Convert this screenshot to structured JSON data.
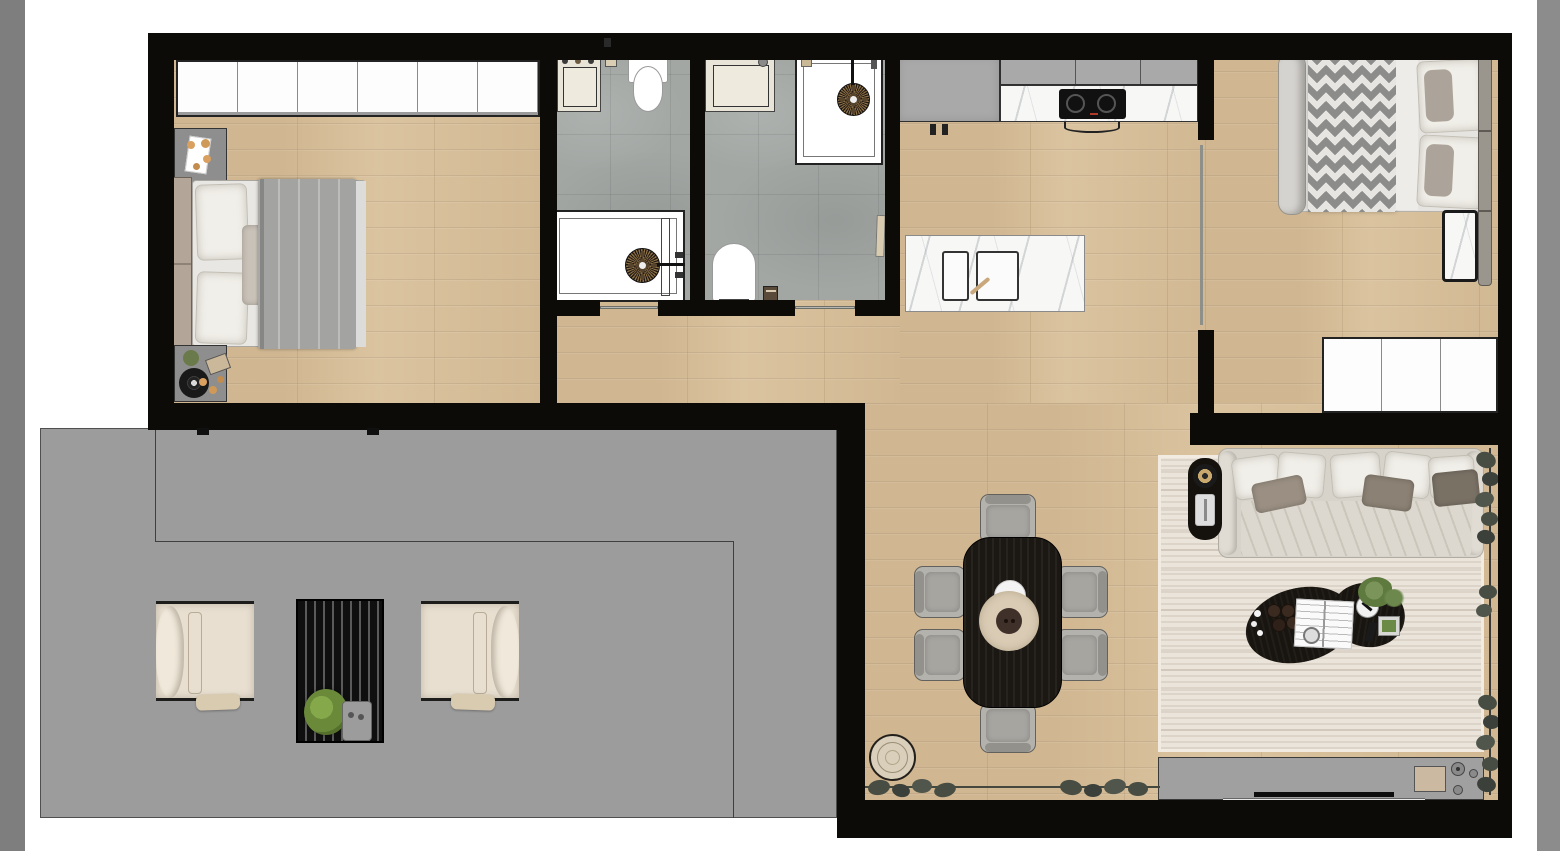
{
  "scene": {
    "kind": "apartment-floor-plan-top-view",
    "style": "rendered interior plan, no visible text labels",
    "canvas": {
      "width": 1560,
      "height": 851,
      "background": "#ffffff"
    }
  },
  "palette": {
    "wall": "#0d0b08",
    "wood_floor": "#d7c09c",
    "bathroom_tile": "#a2a7a4",
    "terrace_concrete": "#9c9c9c",
    "marble": "#f7f7f6",
    "cabinet_gray": "#a9a9a9",
    "cabinet_white": "#fdfdfd",
    "rug": "#eae4db",
    "sofa": "#d7d3ca",
    "pillow_taupe": "#8d8275",
    "dining_table_black": "#1b1713",
    "chair_gray": "#b4b2ad",
    "lounge_chair_cream": "#e8dfd0",
    "plant_green": "#6a8a3a",
    "window_plant_dark": "#474d42",
    "accent_beige": "#d9cbb0",
    "frame_bar_gray": "#7e7e7e"
  },
  "frame": {
    "left_bar": "vertical gray strip at left edge",
    "right_bar": "vertical gray strip at right edge"
  },
  "rooms": {
    "bedroom1": {
      "name": "Bedroom 1",
      "furniture": [
        "six-door wardrobe",
        "nightstand with decor tray",
        "double bed with gray duvet and pillows",
        "nightstand with turntable and plant"
      ]
    },
    "bathroom1": {
      "name": "Bathroom 1",
      "furniture": [
        "vanity sink with three-hole faucet",
        "toilet",
        "accessory holder",
        "walk-in shower with rain head and glass door"
      ]
    },
    "bathroom2": {
      "name": "Bathroom 2",
      "furniture": [
        "towel rail",
        "vanity sink",
        "walk-in shower with rain head",
        "toilet",
        "step stool",
        "hand towel on wall"
      ]
    },
    "kitchen": {
      "name": "Kitchen",
      "furniture": [
        "tall cabinet block",
        "upper cabinet row",
        "marble counter with two-burner cooktop",
        "extractor hood arc",
        "cabinet handles",
        "marble island with double sink and faucet"
      ]
    },
    "hallway": {
      "name": "Hallway",
      "furniture": []
    },
    "bedroom2": {
      "name": "Bedroom 2",
      "furniture": [
        "double bed with chevron runner and rolled blanket",
        "slatted headboard",
        "marble side table",
        "three-door wardrobe"
      ]
    },
    "living_dining": {
      "name": "Living / Dining Room",
      "furniture": [
        "black oval dining table",
        "six gray dining chairs",
        "serving platter with bowl and plate",
        "round jute pouf",
        "area rug",
        "fabric sofa with cushions and throw",
        "black side table with turntable and wine glass",
        "organic black coffee table with books, espresso cups, tray, plant and remote",
        "TV sideboard with soundbar, media box and speaker knobs",
        "window plants along glazing"
      ]
    },
    "terrace": {
      "name": "Terrace",
      "furniture": [
        "cream lounge armchair left",
        "cream lounge armchair right",
        "slatted fire-pit table with plant and tray",
        "paving edge lines"
      ]
    }
  }
}
